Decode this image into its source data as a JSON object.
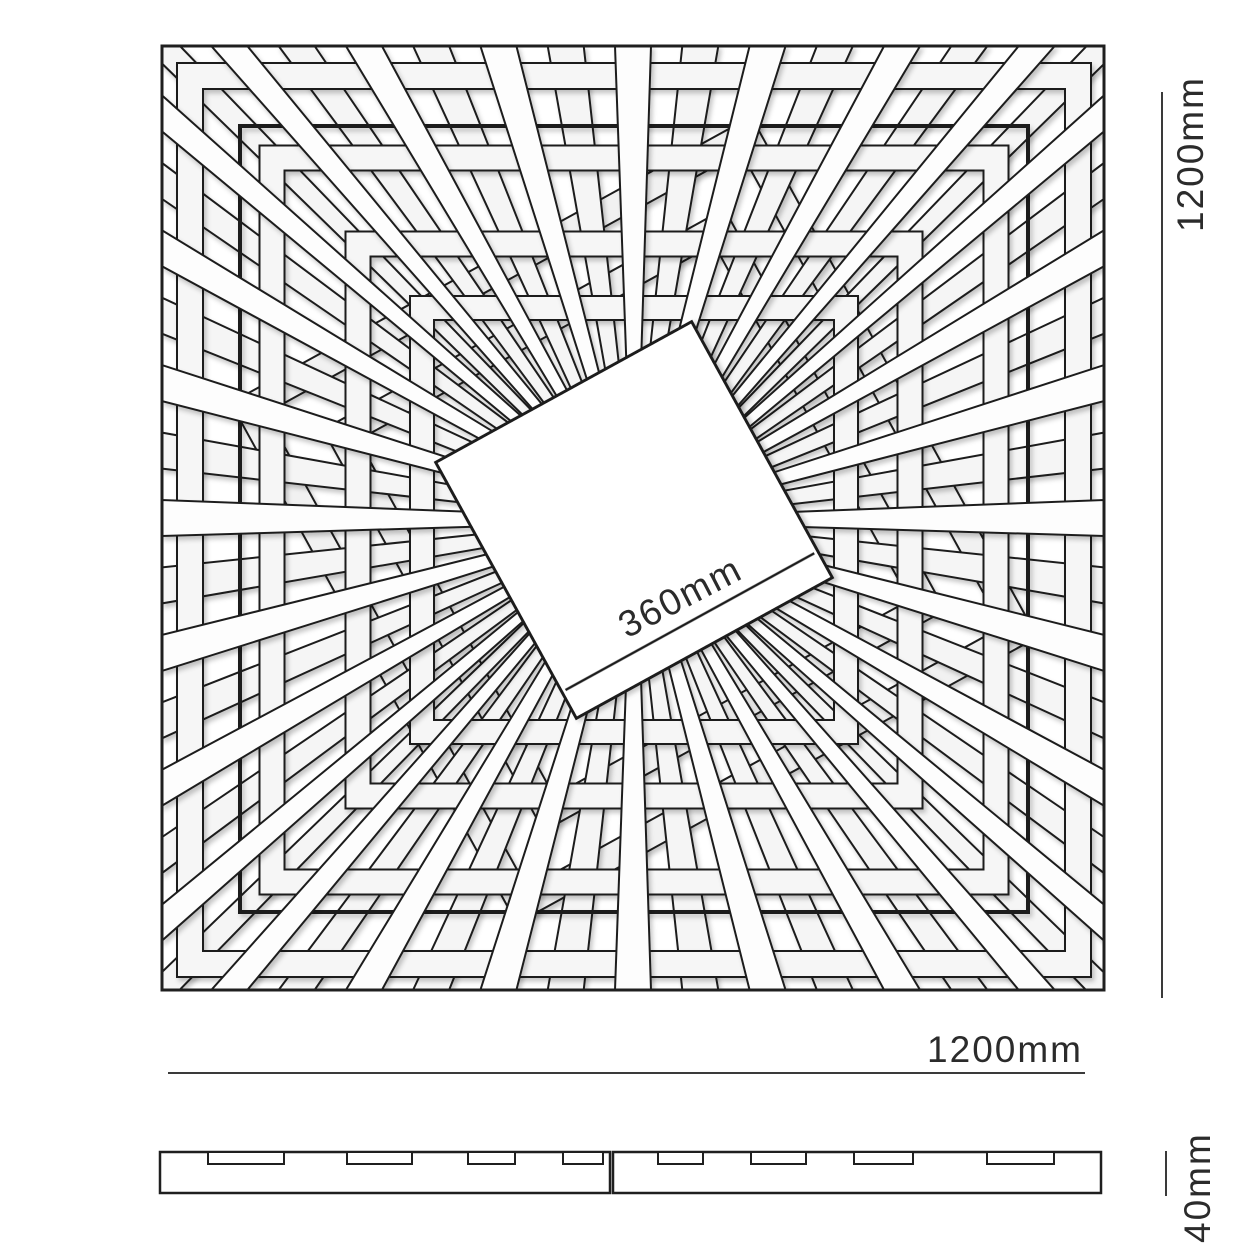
{
  "page": {
    "background": "#ffffff"
  },
  "drawing": {
    "labels": {
      "center_dimension": "360mm",
      "right_dimension": "1200mm",
      "bottom_dimension": "1200mm",
      "profile_thickness": "40mm"
    },
    "colors": {
      "line": "#1f1f1f",
      "dim_line": "#3a3a3a",
      "text": "#2b2b2b",
      "ring_fill": "#f6f6f6",
      "ring_low_fill": "#f1f1f1",
      "ray_under_fill": "#f5f5f5",
      "ray_over_fill": "#fdfdfd",
      "panel_fill": "#ffffff",
      "shadow_opacity": 0.22
    },
    "top_view": {
      "outer_square": {
        "x": 162,
        "y": 46,
        "width": 942,
        "height": 944,
        "stroke_width": 3
      },
      "inner_square": {
        "x": 240,
        "y": 126,
        "width": 788,
        "height": 786,
        "stroke_width": 4
      },
      "center": {
        "x": 634,
        "y": 520
      },
      "center_square": {
        "side": 292,
        "rotation_deg": -28.8,
        "stroke_width": 3,
        "lip_offset": 30
      },
      "center_label": {
        "x": 686,
        "y": 608,
        "angle": -27.5
      },
      "rays": {
        "per_side": 14,
        "tip_width": 36,
        "root_width": 12,
        "root_radius": 118,
        "stroke_width": 2
      },
      "rings": [
        {
          "half_size": 444,
          "slat_width": 26,
          "rotation_deg": 0,
          "layer": "mid"
        },
        {
          "half_size": 362,
          "slat_width": 25,
          "rotation_deg": 0,
          "layer": "mid"
        },
        {
          "half_size": 276,
          "slat_width": 25,
          "rotation_deg": 0,
          "layer": "mid"
        },
        {
          "half_size": 212,
          "slat_width": 24,
          "rotation_deg": 0,
          "layer": "mid"
        },
        {
          "half_size": 216,
          "slat_width": 26,
          "rotation_deg": -28.8,
          "layer": "low"
        },
        {
          "half_size": 284,
          "slat_width": 26,
          "rotation_deg": -28.8,
          "layer": "low"
        }
      ]
    },
    "dimension_right": {
      "x": 1162,
      "y1": 92,
      "y2": 998,
      "text_x": 1203,
      "text_y": 232,
      "stroke_width": 2
    },
    "dimension_bottom": {
      "y": 1073,
      "x1": 168,
      "x2": 1085,
      "text_x": 1083,
      "text_y": 1062,
      "stroke_width": 2
    },
    "profile": {
      "top": 1152,
      "height": 41,
      "left_section": {
        "x1": 160,
        "x2": 610
      },
      "right_section": {
        "x1": 613,
        "x2": 1101
      },
      "stroke_width": 2.5,
      "notch_depth": 12,
      "notches": [
        {
          "x": 208,
          "w": 76
        },
        {
          "x": 347,
          "w": 65
        },
        {
          "x": 468,
          "w": 47
        },
        {
          "x": 563,
          "w": 40
        },
        {
          "x": 658,
          "w": 45
        },
        {
          "x": 751,
          "w": 55
        },
        {
          "x": 854,
          "w": 59
        },
        {
          "x": 987,
          "w": 67
        }
      ],
      "tick": {
        "x": 1166,
        "y1": 1151,
        "y2": 1196
      },
      "text_x": 1210,
      "text_y": 1243
    },
    "font_size": 37
  }
}
